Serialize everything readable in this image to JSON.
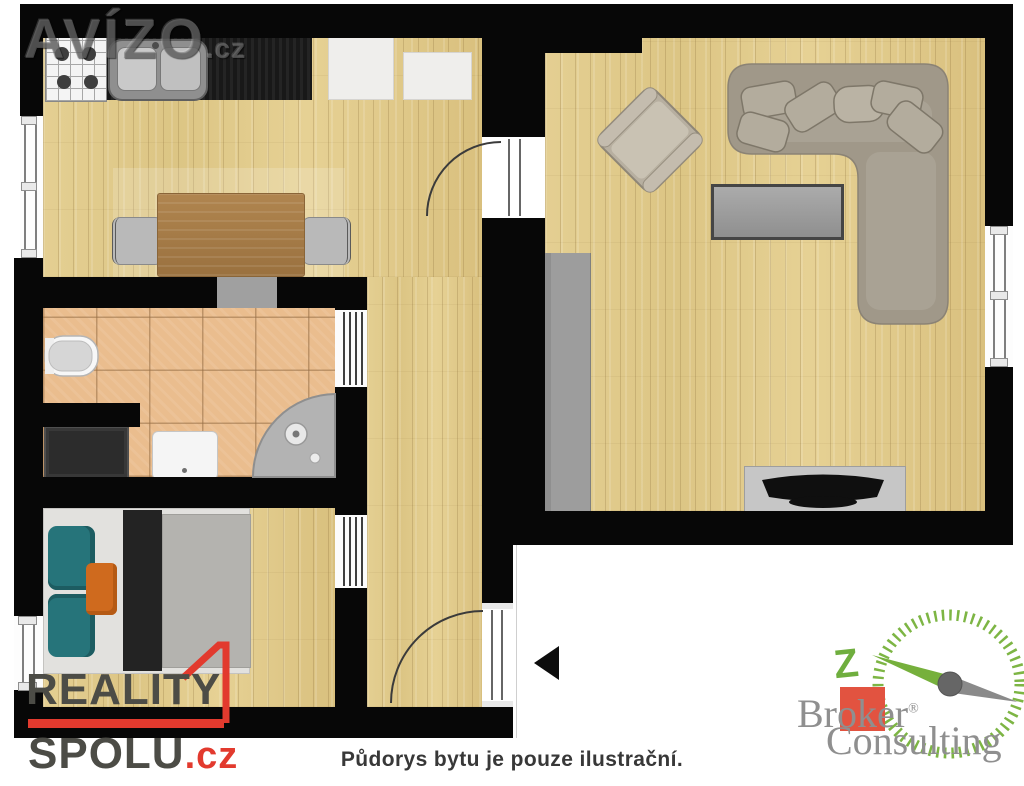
{
  "caption": "Půdorys bytu je pouze ilustrační.",
  "watermarks": {
    "avizo": {
      "name": "AVÍZO",
      "tld": ".cz"
    },
    "reality_spolu": {
      "line1": "REALITY",
      "line2": "SPOLU",
      "tld": ".cz"
    },
    "broker_consulting": {
      "word1": "Broker",
      "word2": "Consulting",
      "registered": "®",
      "compass_letter": "Z"
    }
  },
  "colors": {
    "wall": "#070707",
    "wood_floor": "#e0ca89",
    "tile_floor": "#eabd8e",
    "accent_red": "#e23a2e",
    "logo_green": "#7db544",
    "logo_text_grey": "#8f8f8f",
    "teal_pillow": "#26747a",
    "orange_pillow": "#cf6a1e",
    "caption_text": "#383838"
  }
}
